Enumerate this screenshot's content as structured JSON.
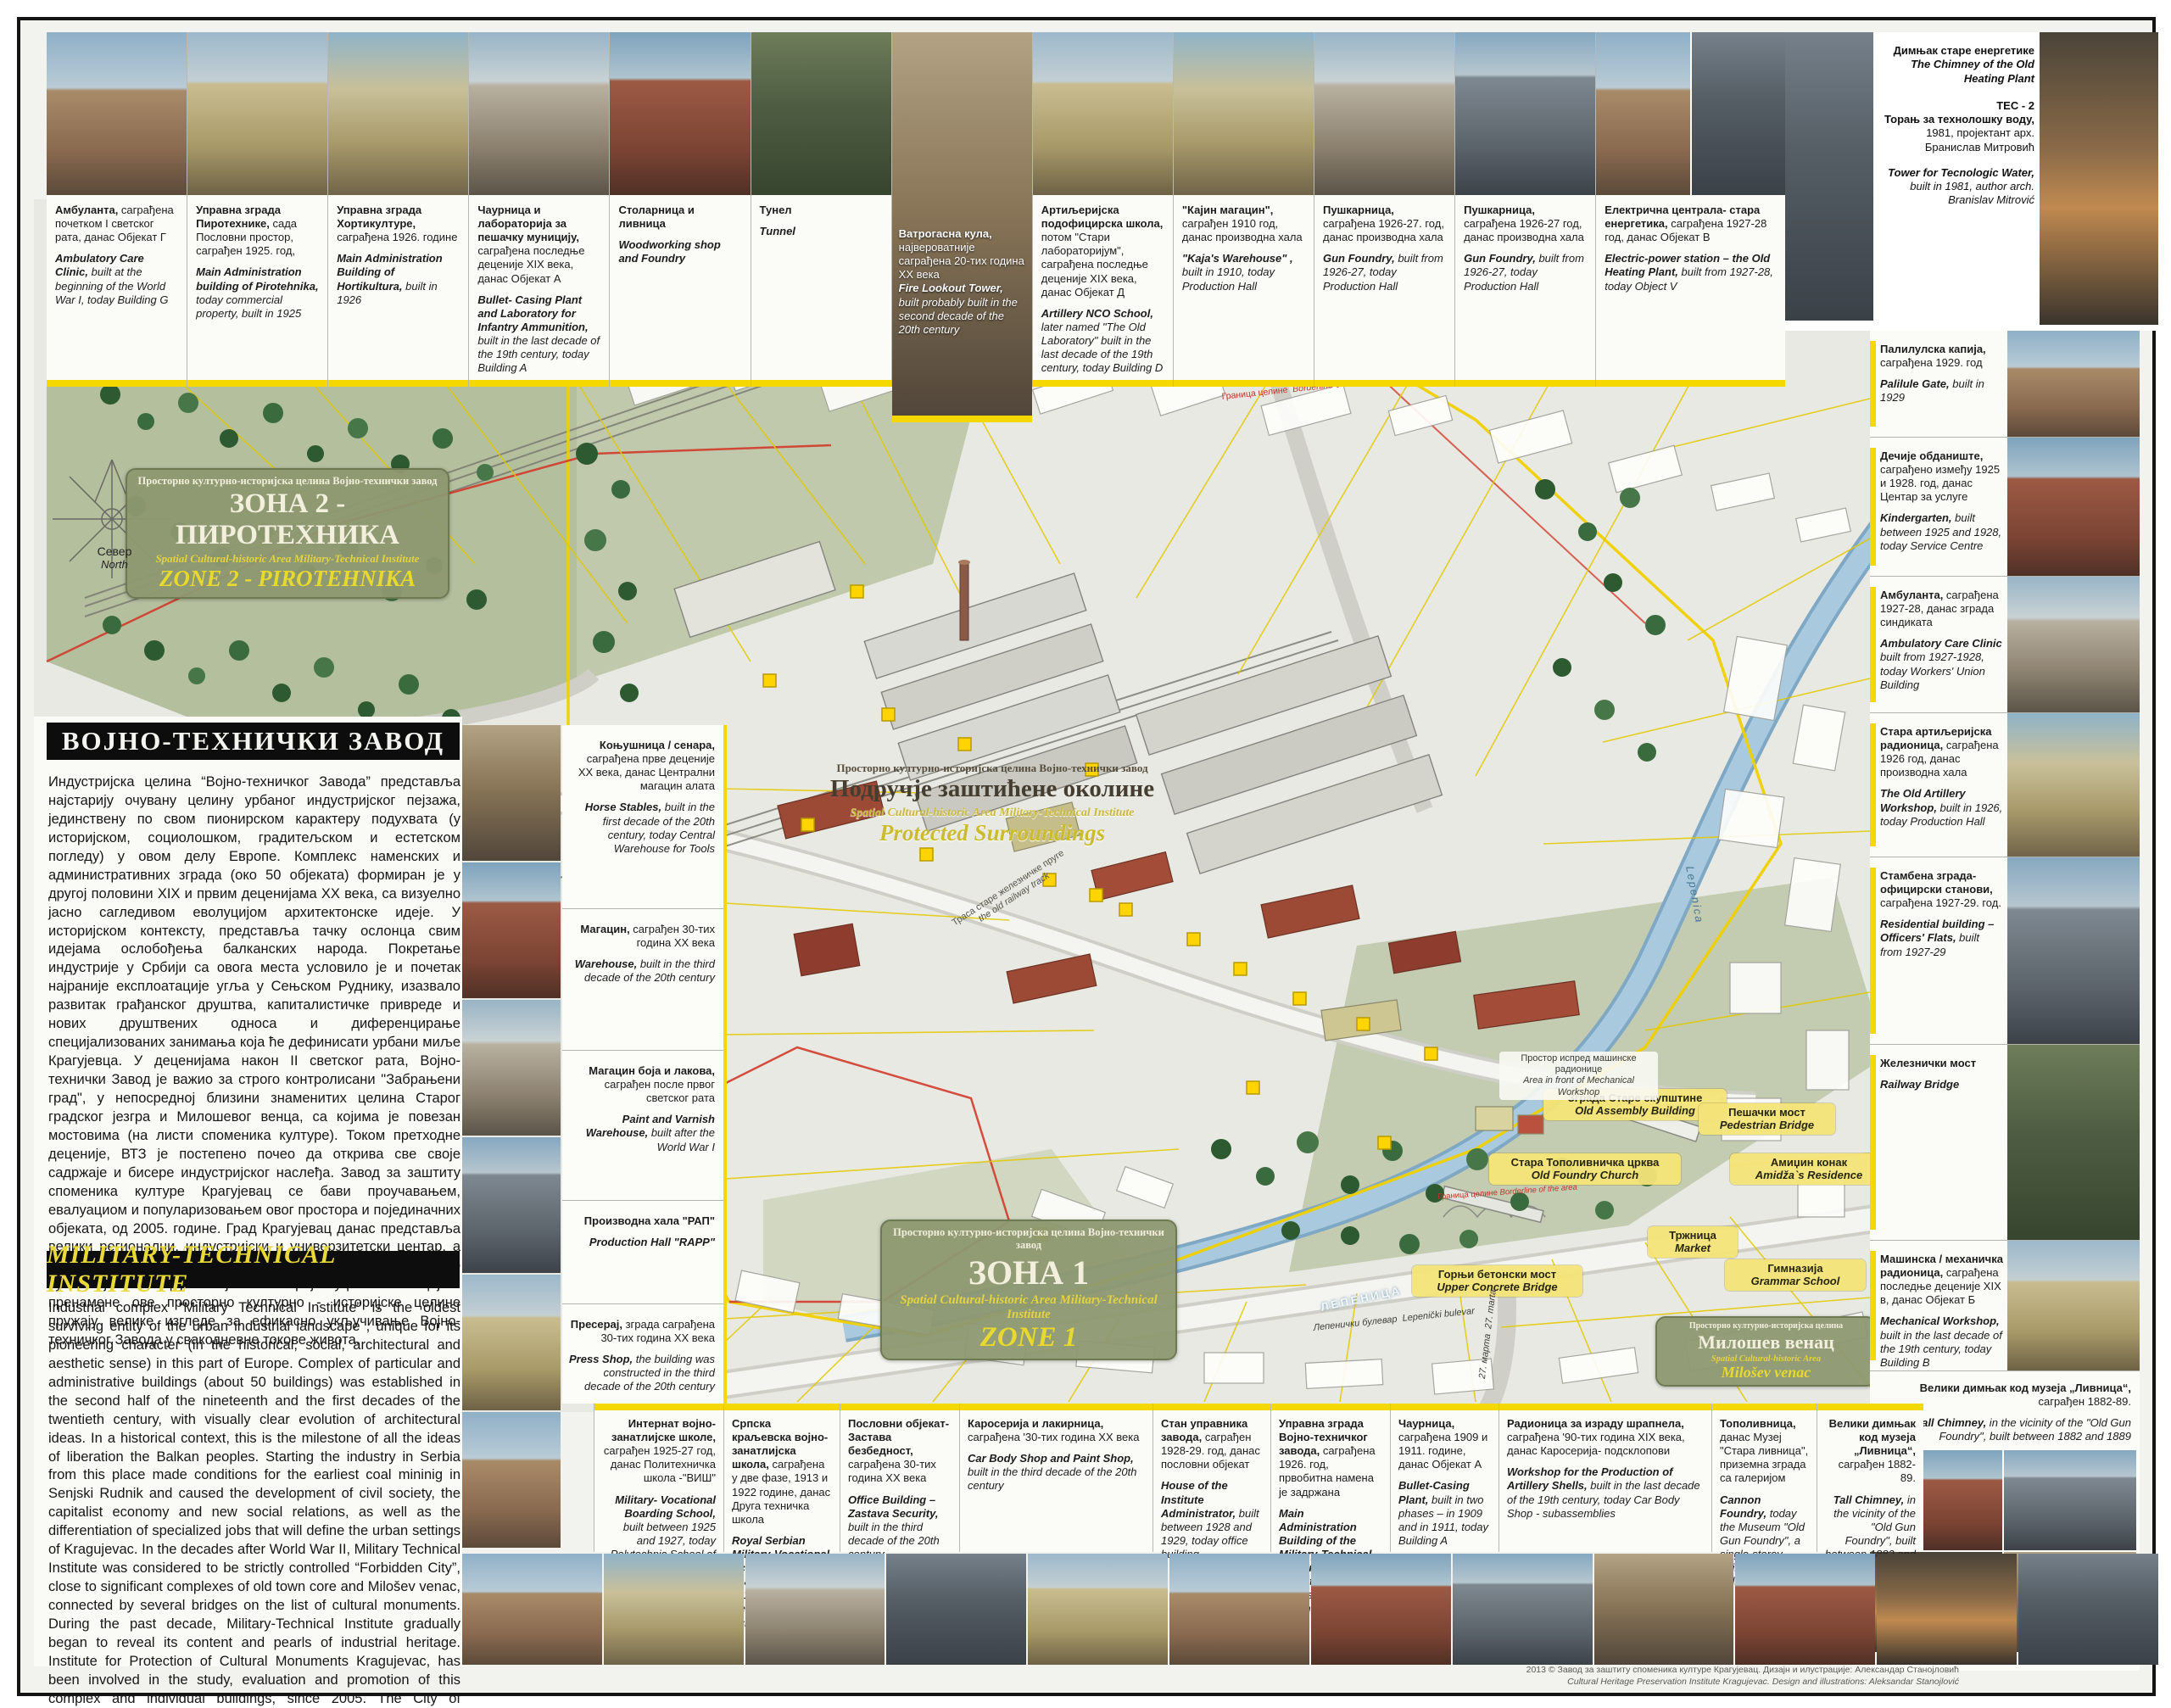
{
  "poster": {
    "title_sr": "ВОЈНО-ТЕХНИЧКИ ЗАВОД",
    "title_en": "MILITARY-TECHNICAL INSTITUTE",
    "intro_sr": "Индустријска целина “Војно-техничког Завода” представља најстарију очувану целину урбаног индустријског пејзажа, јединствену по свом пионирском карактеру подухвата (у историјском, социолошком, градитељском и естетском погледу) у овом делу Европе. Комплекс наменских и административних зграда (око 50 објеката) формиран је у другој половини XIX и првим деценијама XX века, са визуелно јасно сагледивом еволуцијом архитектонске идеје. У историјском контексту, представља тачку ослонца свим идејама ослобођења балканских народа. Покретање индустрије у Србији са овога места условило је и почетак најраније експлоатације угља у Сењском Руднику, изазвало развитак грађанског друштва, капиталистичке привреде и нових друштвених односа и диференцирање специјализованих занимања која ће дефинисати урбани миље Крагујевца. У деценијама након II светског рата, Војно-технички Завод је важио за строго контролисани \"Забрањени град\", у непосредној близини знаменитих целина Старог градског језгра и Милошевог венца, са којима је повезан мостовима (на листи споменика културе). Током претходне деценије, ВТЗ је постепено почео да открива све своје садржаје и бисере индустријског наслеђа. Завод за заштиту споменика културе Крагујевац се бави проучавањем, евалуациом и популаризовањем овог простора и појединачних објеката, од 2005. године. Град Крагујевац данас представља велики регионални, индустријски и универзитетски центар, а последњих деценија преузима примат и у сфери туризма. Ово су значајни потенцијали који самом пројекту ревитализације и пренамене ове просторно културно - историјске целине пружају велике изгледе за ефикасно укључивање Војно-техничког Завода у свакодневне токове живота.",
    "intro_en": "Industrial complex “Military Technical Institute” is the oldest surviving entity of the urban industrial landscape , unique for its pioneering character (in the historical, social, architectural and aesthetic sense) in this part of Europe. Complex of particular and administrative buildings (about 50 buildings) was established in the second half of the nineteenth and the first decades of the twentieth century, with visually clear evolution of architectural ideas. In a historical context, this is the milestone of all the ideas of liberation the Balkan peoples. Starting the industry in Serbia from this place made conditions for the earliest coal mininig in Senjski Rudnik and caused the development of civil society, the capitalist economy and new social relations, as well as the differentiation of specialized jobs that will define the urban settings of Kragujevac. In the decades after World War II, Military Technical Institute was considered to be strictly controlled “Forbidden City”, close to significant complexes of old town core and Milošev venac, connected by several bridges on the list of cultural monuments. During the past decade, Military-Technical Institute gradually began to reveal its content and pearls of industrial heritage. Institute for Protection of Cultural Monuments Kragujevac, has been involved in the study, evaluation and promotion of this complex and individual buildings, since 2005. The City of Kragujevac is today a major regional, industrial and university center, and takes precedence in the sphere of tourism in recent decades. These are significant resources which offer the project of rehabilitation and reuse of the spatial cultural - historical site, great prospects for effective integration into everyday city life flows.",
    "footer_sr": "2013 © Завод за заштиту споменика културе Крагујевац.      Дизајн и илустрације: Александар Станојловић",
    "footer_en": "Cultural Heritage Preservation Institute Kragujevac.      Design and illustrations: Aleksandar Stanojlović"
  },
  "compass": {
    "sr": "Север",
    "en": "North"
  },
  "zone2": {
    "l1": "Просторно културно-историјска целина Војно-технички завод",
    "l2": "ЗОНА 2 - ПИРОТЕХНИКА",
    "l3": "Spatial Cultural-historic Area Military-Technical Institute",
    "l4": "ZONE 2 - PIROTEHNIKA"
  },
  "protected": {
    "l1": "Просторно културно-историјска целина Војно-технички завод",
    "l2": "Подручје заштићене околине",
    "l3": "Spatial Cultural-historic Area Military-Technical Institute",
    "l4": "Protected Surroundings"
  },
  "zone1": {
    "l1": "Просторно културно-историјска целина Војно-технички завод",
    "l2": "ЗОНА 1",
    "l3": "Spatial Cultural-historic Area Military-Technical Institute",
    "l4": "ZONE 1"
  },
  "milosev": {
    "l1": "Просторно културно-историјска целина",
    "l2": "Милошев венац",
    "l3": "Spatial Cultural-historic Area",
    "l4": "Milošev venac"
  },
  "top_cards": [
    {
      "sb": "Амбуланта,",
      "sr": " саграђена почетком I светског рата, данас Објекат Г",
      "eb": "Ambulatory Care Clinic,",
      "er": " built at the beginning of the World War I, today Building G"
    },
    {
      "sb": "Управна зграда Пиротехнике,",
      "sr": " сада Пословни простор, саграђен 1925. год,",
      "eb": "Main Administration building of Pirotehnika,",
      "er": " today commercial property, built in 1925"
    },
    {
      "sb": "Управна зграда Хортикултуре,",
      "sr": " саграђена 1926. године",
      "eb": "Main Administration Building of Hortikultura,",
      "er": " built in 1926"
    },
    {
      "sb": "Чаурница и лабораторија за пешачку муницију,",
      "sr": " саграђена последње деценије XIX века, данас Објекат А",
      "eb": "Bullet- Casing Plant and Laboratory for Infantry Ammunition,",
      "er": " built in the last decade of the 19th century, today Building A"
    },
    {
      "sb": "Столарница и ливница",
      "sr": "",
      "eb": "Woodworking shop and Foundry",
      "er": ""
    },
    {
      "sb": "Тунел",
      "sr": "",
      "eb": "Tunnel",
      "er": ""
    },
    {
      "sb": "Ватрогасна кула,",
      "sr": " највероватније саграђена 20-тих година XX века",
      "eb": "Fire Lookout Tower,",
      "er": " built probably built in the second decade of the 20th century"
    },
    {
      "sb": "Артиљеријска подофицирска школа,",
      "sr": " потом \"Стари лабораторијум\", саграђена последње деценије XIX века, данас Објекат Д",
      "eb": "Artillery NCO School,",
      "er": " later named \"The Old Laboratory\" built in the last decade of the 19th century, today Building D"
    },
    {
      "sb": "\"Кајин магацин\",",
      "sr": " саграђен 1910 год, данас производна хала",
      "eb": "\"Kaja's Warehouse\" ,",
      "er": " built in 1910, today Production Hall"
    },
    {
      "sb": "Пушкарница,",
      "sr": " саграђена 1926-27. год, данас производна хала",
      "eb": "Gun Foundry,",
      "er": " built from 1926-27, today Production Hall"
    },
    {
      "sb": "Пушкарница,",
      "sr": " саграђена 1926-27 год, данас производна хала",
      "eb": "Gun Foundry,",
      "er": " built from 1926-27, today Production Hall"
    },
    {
      "sb": "Електрична централа- стара енергетика,",
      "sr": " саграђена 1927-28 год, данас Објекат В",
      "eb": "Electric-power station – the Old Heating Plant,",
      "er": " built from 1927-28, today Object V"
    }
  ],
  "corner": {
    "chimney_sr": "Димњак старе енергетике",
    "chimney_en": "The Chimney of the Old Heating Plant",
    "tec": "ТЕС - 2",
    "tower_sb": "Торањ за технолошку воду,",
    "tower_sr": " 1981, пројектант арх. Бранислав Митровић",
    "tower_eb": "Tower for Tecnologic Water,",
    "tower_er": " built in 1981, author arch. Branislav Mitrović"
  },
  "right_cards": [
    {
      "sb": "Палилулска капија,",
      "sr": " саграђена 1929. год",
      "eb": "Palilule Gate,",
      "er": " built in 1929"
    },
    {
      "sb": "Дечије обданиште,",
      "sr": " саграђено између 1925 и 1928. год, данас Центар за услуге",
      "eb": "Kindergarten,",
      "er": " built between 1925 and 1928, today Service Centre"
    },
    {
      "sb": "Амбуланта,",
      "sr": " саграђена 1927-28, данас зграда синдиката",
      "eb": "Ambulatory Care Clinic",
      "er": " built from 1927-1928, today Workers' Union Building"
    },
    {
      "sb": "Стара артиљеријска радионица,",
      "sr": " саграђена 1926 год, данас производна хала",
      "eb": "The Old Artillery Workshop,",
      "er": " built in 1926, today Production Hall"
    },
    {
      "sb": "Стамбена зграда- официрски станови,",
      "sr": " саграђена 1927-29. год.",
      "eb": "Residential building – Officers' Flats,",
      "er": " built from 1927-29"
    },
    {
      "sb": "Железнички мост",
      "sr": "",
      "eb": "Railway Bridge",
      "er": ""
    },
    {
      "sb": "Машинска / механичка радионица,",
      "sr": " саграђена последње деценије XIX в, данас Објекат Б",
      "eb": "Mechanical Workshop,",
      "er": " built in the last decade of the 19th century, today Building B"
    },
    {
      "sb": "Велики димњак код музеја „Ливница“,",
      "sr": " саграђен 1882-89.",
      "eb": "Tall Chimney,",
      "er": " in the vicinity of the \"Old Gun Foundry\", built between 1882 and 1889"
    }
  ],
  "left_cards": [
    {
      "sb": "Коњушница / сенара,",
      "sr": " саграђена прве деценије XX века, данас Централни магацин алата",
      "eb": "Horse Stables,",
      "er": " built in the first decade of the 20th century, today Central Warehouse for Tools"
    },
    {
      "sb": "Магацин,",
      "sr": " саграђен 30-тих година XX века",
      "eb": "Warehouse,",
      "er": " built in the third decade of the 20th century"
    },
    {
      "sb": "Магацин боја и лакова,",
      "sr": " саграђен после првог светског рата",
      "eb": "Paint and Varnish Warehouse,",
      "er": " built after the World War I"
    },
    {
      "sb": "Производна хала \"РАП\"",
      "sr": "",
      "eb": "Production Hall \"RAPP\"",
      "er": ""
    },
    {
      "sb": "Пресерај,",
      "sr": " зграда саграђена 30-тих година XX века",
      "eb": "Press Shop,",
      "er": " the building was constructed in the third decade of the 20th century"
    }
  ],
  "bottom_cards": [
    {
      "sb": "Интернат војно-занатлијске школе,",
      "sr": " саграђен 1925-27 год, данас Политехничка школа -\"ВИШ\"",
      "eb": "Military- Vocational Boarding School,",
      "er": " built between 1925 and 1927, today Polytechnic School of Kragujevac (PSK)"
    },
    {
      "sb": "Српска краљевска војно-занатлијска школа,",
      "sr": " саграђена у две фазе, 1913 и 1922 године, данас Друга техничка школа",
      "eb": "Royal Serbian Military-Vocational School,",
      "er": " built in two phases, in 1913 and in 1922, today Second Technical School"
    },
    {
      "sb": "Пословни објекат- Застава безбедност,",
      "sr": " саграђена 30-тих година XX века",
      "eb": "Office Building – Zastava Security,",
      "er": " built in the third decade of the 20th century"
    },
    {
      "sb": "Каросерија и лакирница,",
      "sr": " саграђена '30-тих година XX века",
      "eb": "Car Body Shop and Paint Shop,",
      "er": " built in the third decade of the 20th century"
    },
    {
      "sb": "Стан управника завода,",
      "sr": " саграђен 1928-29. год, данас пословни објекат",
      "eb": "House of the Institute Administrator,",
      "er": " built between 1928 and 1929, today office building"
    },
    {
      "sb": "Управна зграда Војно-техничког завода,",
      "sr": " саграђена 1926. год, првобитна намена је задржана",
      "eb": "Main Administration Building of the Military-Technical Institute,",
      "er": " built in 1926, the original purpose of the building is kept"
    },
    {
      "sb": "Чаурница,",
      "sr": " саграђена 1909 и 1911. године, данас Објекат А",
      "eb": "Bullet-Casing Plant,",
      "er": " built in two phases – in 1909 and in 1911, today Building A"
    },
    {
      "sb": "Радионица за израду шрапнела,",
      "sr": " саграђена '90-тих година XIX века, данас Каросерија- подсклопови",
      "eb": "Workshop for the Production of Artillery Shells,",
      "er": " built in the last decade of the 19th century, today Car Body Shop - subassemblies"
    },
    {
      "sb": "Тополивница,",
      "sr": " данас Музеј \"Стара ливница\", приземна зграда са галеријом",
      "eb": "Cannon Foundry,",
      "er": " today the Museum \"Old Gun Foundry\", a single-storey building with a gallery"
    },
    {
      "sb": "Велики димњак код музеја „Ливница“,",
      "sr": " саграђен 1882-89.",
      "eb": "Tall Chimney,",
      "er": " in the vicinity of the \"Old Gun Foundry\", built between 1882 and 1889"
    }
  ],
  "map_labels": {
    "assembly": {
      "sr": "Зграда Старе скупштине",
      "en": "Old Assembly Building"
    },
    "pedestrian": {
      "sr": "Пешачки мост",
      "en": "Pedestrian Bridge"
    },
    "church": {
      "sr": "Стара Тополивничка црква",
      "en": "Old Foundry Church"
    },
    "amidza": {
      "sr": "Амиџин конак",
      "en": "Amidža`s Residence"
    },
    "market": {
      "sr": "Тржница",
      "en": "Market"
    },
    "grammar": {
      "sr": "Гимназија",
      "en": "Grammar School"
    },
    "upper_bridge": {
      "sr": "Горњи бетонски мост",
      "en": "Upper Concrete Bridge"
    },
    "mech_area": {
      "sr": "Простор испред машинске радионице",
      "en": "Area in front of Mechanical Workshop"
    },
    "railway": {
      "sr": "Траса старе железничке пруге",
      "en": "the old railway track"
    },
    "border": {
      "sr": "Граница целине",
      "en": "Borderline of the area"
    },
    "blvd": {
      "sr": "Лепенички булевар",
      "en": "Lepenički bulevar"
    },
    "street27": {
      "sr": "27. марта",
      "en": "27. marta"
    },
    "river_sr": "ЛЕПЕНИЦА",
    "river_en": "Lepenica"
  }
}
